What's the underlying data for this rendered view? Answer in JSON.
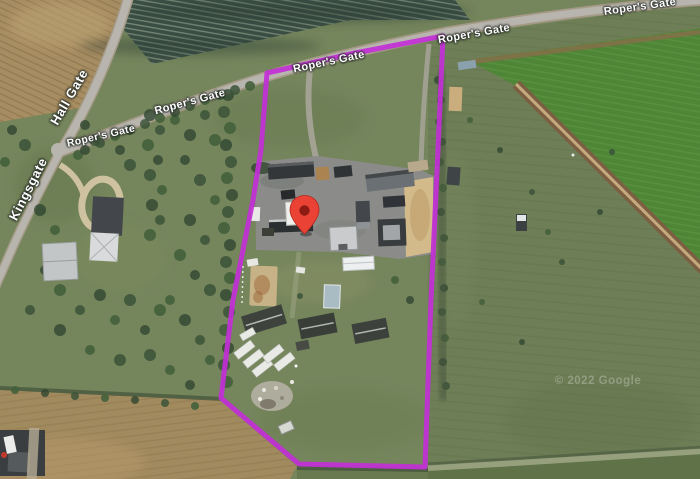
{
  "map": {
    "attribution": "© 2022 Google",
    "boundary_color": "#c22fd6",
    "pin_color": "#ea4335",
    "road_labels": [
      {
        "id": "hall-gate",
        "text": "Hall Gate"
      },
      {
        "id": "kingsgate",
        "text": "Kingsgate"
      },
      {
        "id": "ropers-gate-junction",
        "text": "Roper's Gate"
      },
      {
        "id": "ropers-gate-west",
        "text": "Roper's Gate"
      },
      {
        "id": "ropers-gate-boundary",
        "text": "Roper's Gate"
      },
      {
        "id": "ropers-gate-east",
        "text": "Roper's Gate"
      },
      {
        "id": "ropers-gate-far-east",
        "text": "Roper's Gate"
      }
    ]
  }
}
